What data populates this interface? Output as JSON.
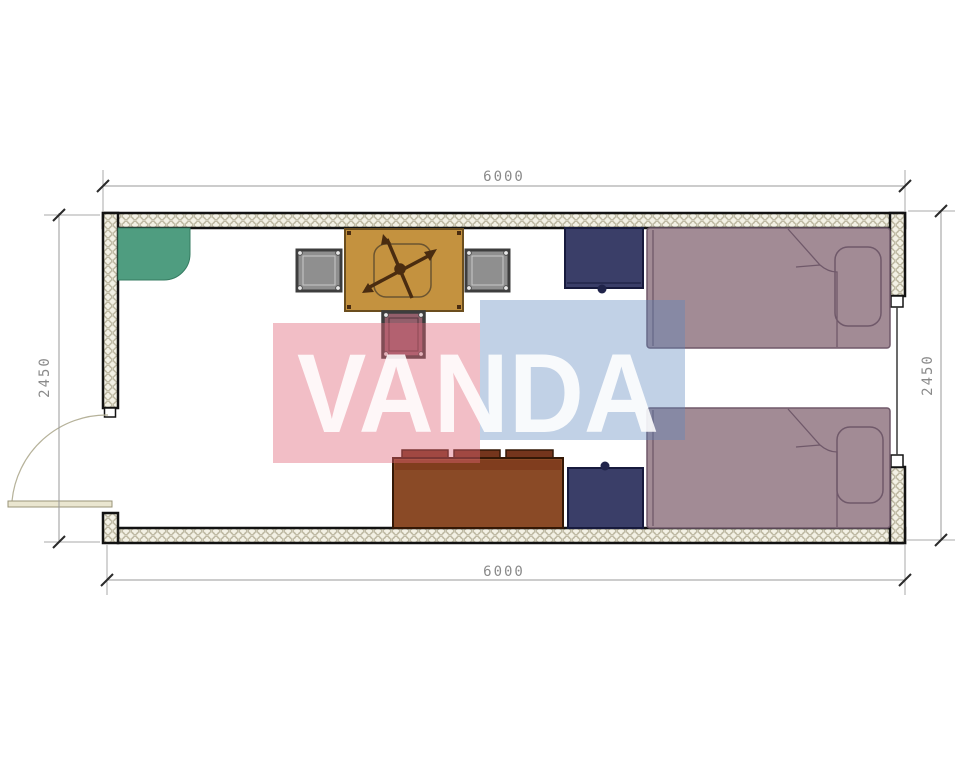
{
  "watermark": {
    "text": "VANDA",
    "pink_color": "#e06377",
    "blue_color": "#5b87bd",
    "text_color": "#ffffff"
  },
  "dimensions": {
    "top": "6000",
    "bottom": "6000",
    "left": "2450",
    "right": "2450"
  },
  "plan": {
    "wall_fill": "#f3f1e5",
    "wall_edge": "#121212",
    "floor_color": "#ffffff",
    "furniture": [
      {
        "name": "corner-shelf",
        "color": "#4f9d80"
      },
      {
        "name": "table-with-fan",
        "color": "#c4923f"
      },
      {
        "name": "stool-left",
        "color": "#8f8f8f"
      },
      {
        "name": "stool-right",
        "color": "#8f8f8f"
      },
      {
        "name": "stool-front",
        "color": "#935f6b"
      },
      {
        "name": "cabinet-top",
        "color": "#3a3e68"
      },
      {
        "name": "cabinet-bottom",
        "color": "#3a3e68"
      },
      {
        "name": "sideboard",
        "color": "#8a4a26"
      },
      {
        "name": "bed-top",
        "color": "#a28b95"
      },
      {
        "name": "bed-bottom",
        "color": "#a28b95"
      },
      {
        "name": "door",
        "color": "#eae6d0"
      },
      {
        "name": "window",
        "color": "#333333"
      }
    ]
  }
}
